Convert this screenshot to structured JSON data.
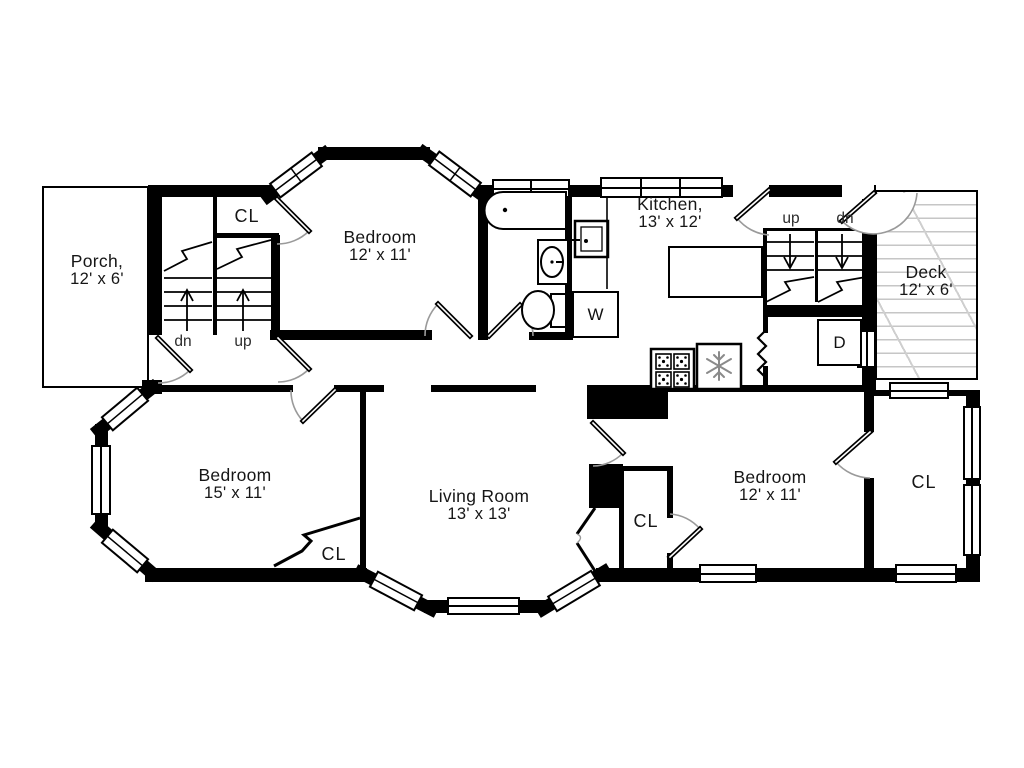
{
  "rooms": {
    "porch": {
      "name": "Porch,",
      "dims": "12' x 6'"
    },
    "upper_bedroom": {
      "name": "Bedroom",
      "dims": "12' x 11'"
    },
    "kitchen": {
      "name": "Kitchen,",
      "dims": "13' x 12'"
    },
    "deck": {
      "name": "Deck",
      "dims": "12' x 6'"
    },
    "left_bedroom": {
      "name": "Bedroom",
      "dims": "15' x 11'"
    },
    "living_room": {
      "name": "Living Room",
      "dims": "13' x 13'"
    },
    "right_bedroom": {
      "name": "Bedroom",
      "dims": "12' x 11'"
    }
  },
  "closets": {
    "hall": "CL",
    "left_bedroom": "CL",
    "right_bedroom": "CL",
    "sunroom": "CL"
  },
  "stairs": {
    "front": {
      "left_label": "dn",
      "right_label": "up"
    },
    "back": {
      "left_label": "up",
      "right_label": "dn"
    }
  },
  "appliances": {
    "washer": "W",
    "dryer": "D"
  },
  "colors": {
    "wall": "#000000",
    "door_arc": "#9a9a9a",
    "deck_hatch": "#c6c6c6",
    "background": "#ffffff",
    "text": "#161616"
  }
}
